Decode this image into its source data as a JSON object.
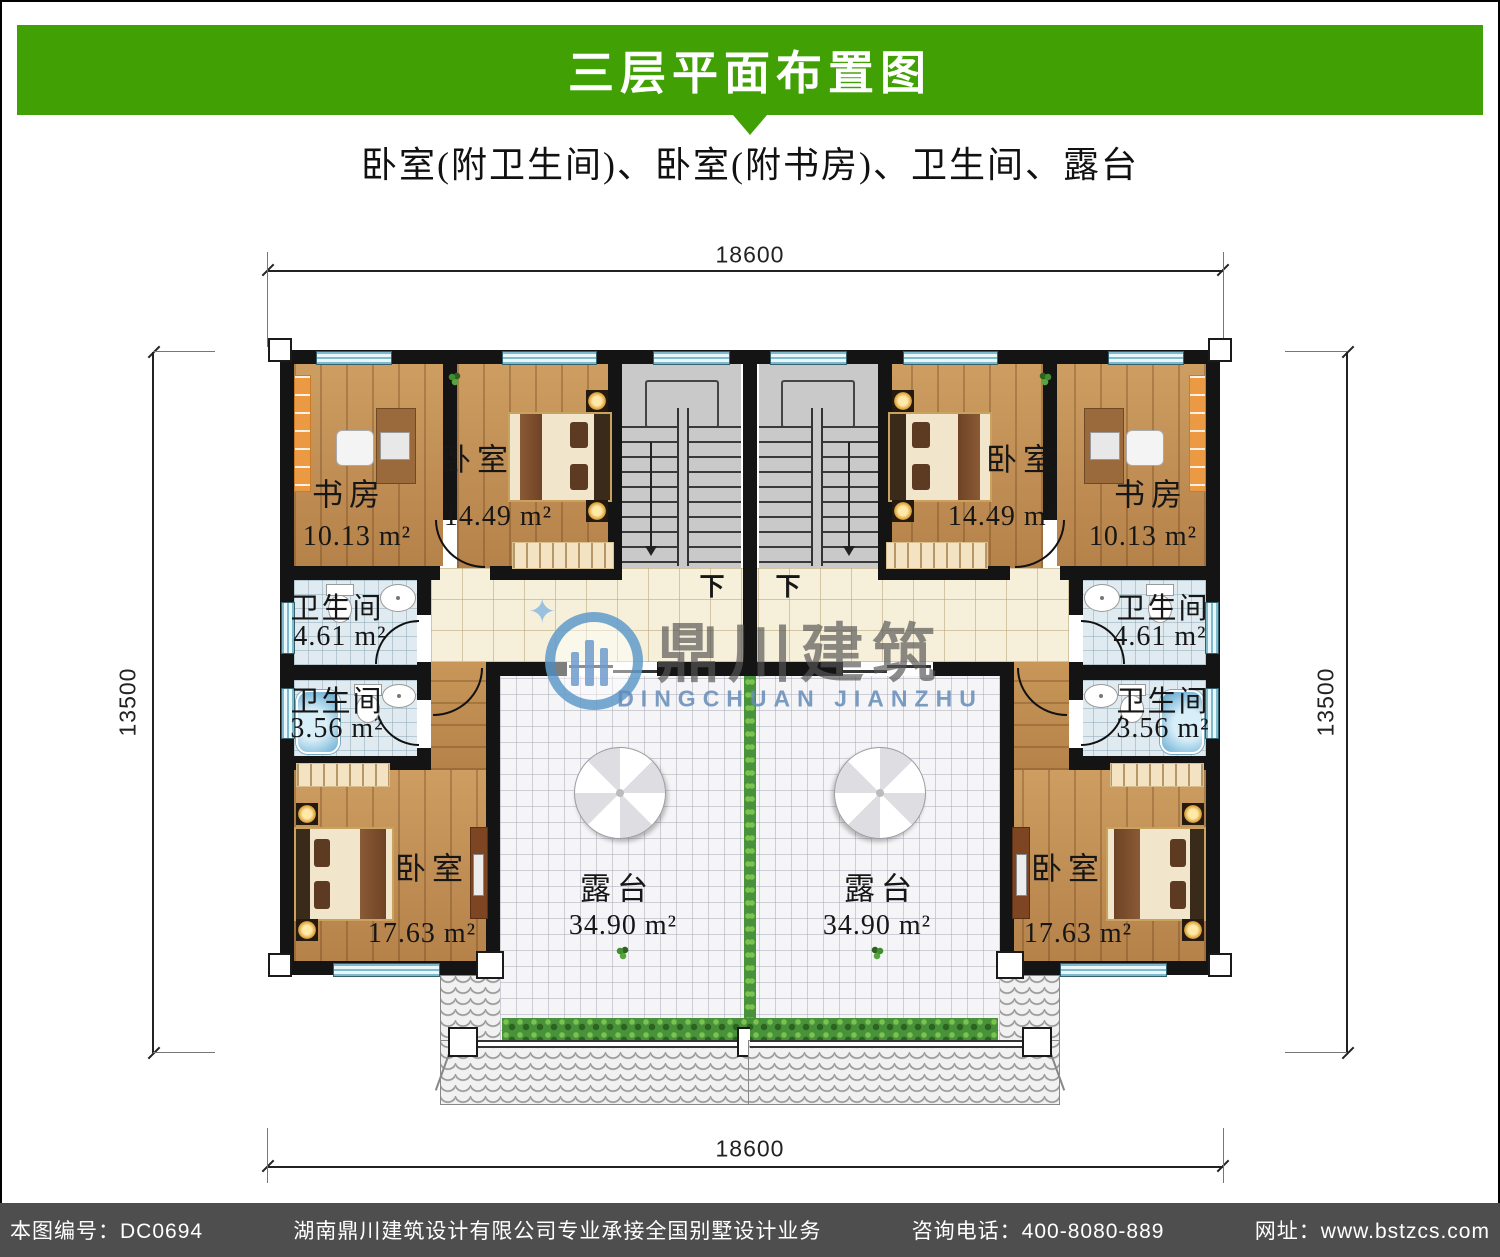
{
  "header": {
    "title": "三层平面布置图",
    "subtitle": "卧室(附卫生间)、卧室(附书房)、卫生间、露台",
    "banner_color": "#41A003"
  },
  "dimensions": {
    "top": "18600",
    "bottom": "18600",
    "left": "13500",
    "right": "13500"
  },
  "stairs": {
    "down_left": "下",
    "down_right": "下"
  },
  "rooms": {
    "left": {
      "study": {
        "name": "书房",
        "area": "10.13 m²"
      },
      "bedroom_top": {
        "name": "卧室",
        "area": "14.49 m²"
      },
      "bath_large": {
        "name": "卫生间",
        "area": "4.61 m²"
      },
      "bath_small": {
        "name": "卫生间",
        "area": "3.56 m²"
      },
      "bedroom_bottom": {
        "name": "卧室",
        "area": "17.63 m²"
      },
      "terrace": {
        "name": "露台",
        "area": "34.90 m²"
      }
    },
    "right": {
      "study": {
        "name": "书房",
        "area": "10.13 m²"
      },
      "bedroom_top": {
        "name": "卧室",
        "area": "14.49 m²"
      },
      "bath_large": {
        "name": "卫生间",
        "area": "4.61 m²"
      },
      "bath_small": {
        "name": "卫生间",
        "area": "3.56 m²"
      },
      "bedroom_bottom": {
        "name": "卧室",
        "area": "17.63 m²"
      },
      "terrace": {
        "name": "露台",
        "area": "34.90 m²"
      }
    }
  },
  "watermark": {
    "cn": "鼎川建筑",
    "en": "DINGCHUAN JIANZHU",
    "blue": "#5f97c6"
  },
  "footer": {
    "sheet_no": "本图编号：DC0694",
    "company": "湖南鼎川建筑设计有限公司专业承接全国别墅设计业务",
    "phone": "咨询电话：400-8080-889",
    "website": "网址：www.bstzcs.com",
    "bg": "#4e4e4e"
  }
}
